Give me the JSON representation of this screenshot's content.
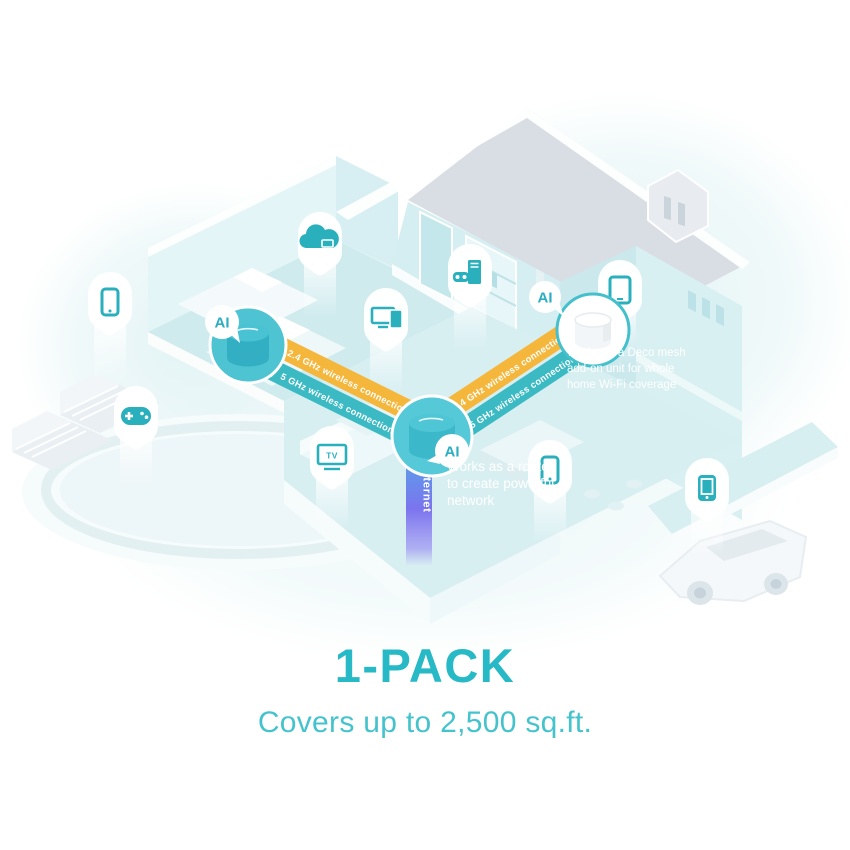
{
  "headline": {
    "title": "1-PACK",
    "subtitle": "Covers up to 2,500 sq.ft."
  },
  "connections": {
    "arrows_left": "❮❮❮",
    "arrows_right": "❯❯❯",
    "left": {
      "band_24": "2.4 GHz wireless connection",
      "band_5": "5 GHz wireless connection"
    },
    "right": {
      "band_24": "2.4 GHz wireless connection",
      "band_5": "5 GHz wireless connection"
    }
  },
  "internet_label": "Internet",
  "ai_badge": "AI",
  "tv_label": "TV",
  "annotations": {
    "router": {
      "lines": [
        "Works as a router",
        "to create powerful",
        "network"
      ]
    },
    "mesh": {
      "lines": [
        "Works as a Deco mesh",
        "add-on unit for whole",
        "home Wi-Fi coverage"
      ]
    }
  },
  "device_icons": [
    "smartphone-icon",
    "game-controller-icon",
    "cloud-storage-icon",
    "monitor-tablet-icon",
    "pc-vr-icon",
    "tv-icon",
    "smartphone-icon",
    "tablet-icon",
    "smartphone-filled-icon"
  ],
  "colors": {
    "band_orange": "#f5b63c",
    "band_teal": "#3bbac4",
    "icon_teal": "#2aafbd",
    "unit_teal": "#4ec3d2",
    "headline": "#28b9c6",
    "subtitle": "#45c3cd",
    "internet_top": "#55a6e8",
    "internet_bottom": "#8273ee",
    "roof_gray": "#d9dde4"
  }
}
